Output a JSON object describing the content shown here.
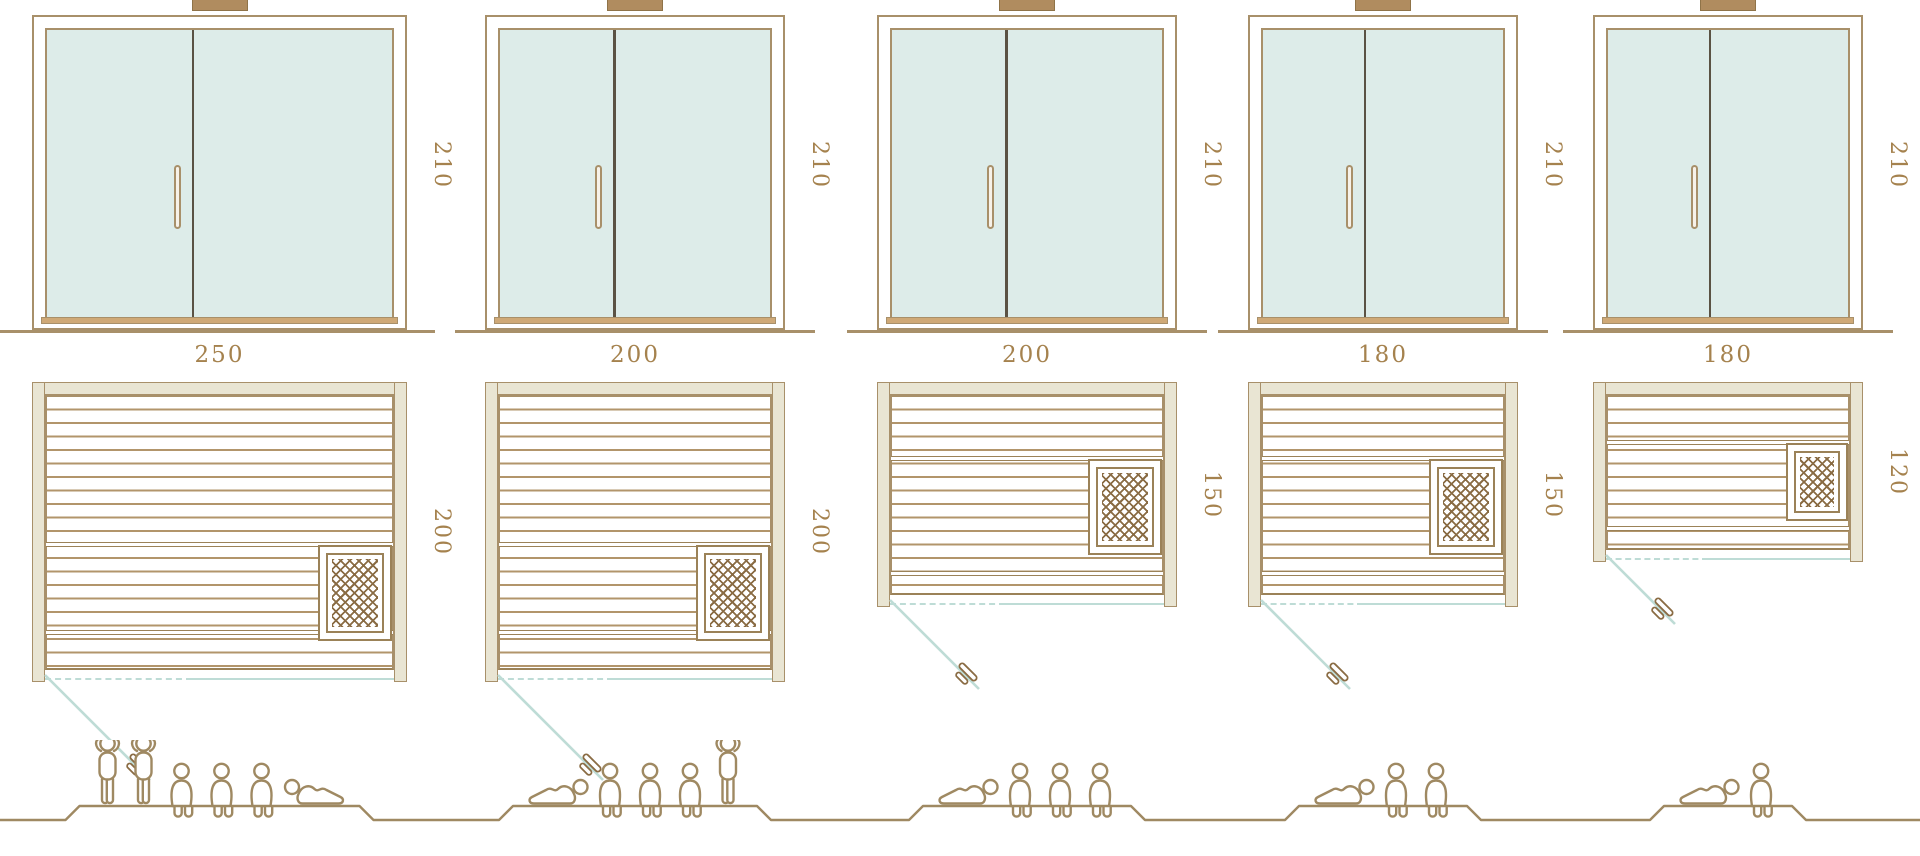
{
  "diagram_type": "sauna-size-comparison-drawing",
  "colors": {
    "line_tan": "#a8906a",
    "line_dark_tan": "#9b8258",
    "label_brown": "#a5824e",
    "glass_fill": "#ddece9",
    "teal_line": "#bedcd6",
    "wall_fill": "#e9e5d3",
    "door_divider": "#5a5244",
    "heater_hatch": "#8a6c44",
    "figure_line": "#9f8962",
    "cap_fill": "#b08c5f",
    "sill_fill": "#cfa977",
    "background": "#ffffff"
  },
  "units": [
    {
      "id": "sauna-250x200",
      "door_height_label": "210",
      "width_label": "250",
      "depth_label": "200",
      "width_cm": 250,
      "depth_cm": 200,
      "door_height_cm": 210,
      "capacity": 6,
      "people_order": [
        "stand",
        "stand",
        "sit",
        "sit",
        "sit",
        "lieL"
      ]
    },
    {
      "id": "sauna-200x200",
      "door_height_label": "210",
      "width_label": "200",
      "depth_label": "200",
      "width_cm": 200,
      "depth_cm": 200,
      "door_height_cm": 210,
      "capacity": 5,
      "people_order": [
        "lie",
        "sit",
        "sit",
        "sit",
        "stand"
      ]
    },
    {
      "id": "sauna-200x150",
      "door_height_label": "210",
      "width_label": "200",
      "depth_label": "150",
      "width_cm": 200,
      "depth_cm": 150,
      "door_height_cm": 210,
      "capacity": 4,
      "people_order": [
        "lie",
        "sit",
        "sit",
        "sit"
      ]
    },
    {
      "id": "sauna-180x150",
      "door_height_label": "210",
      "width_label": "180",
      "depth_label": "150",
      "width_cm": 180,
      "depth_cm": 150,
      "door_height_cm": 210,
      "capacity": 3,
      "people_order": [
        "lie",
        "sit",
        "sit"
      ]
    },
    {
      "id": "sauna-180x120",
      "door_height_label": "210",
      "width_label": "180",
      "depth_label": "120",
      "width_cm": 180,
      "depth_cm": 120,
      "door_height_cm": 210,
      "capacity": 2,
      "people_order": [
        "lie",
        "sit"
      ]
    }
  ]
}
